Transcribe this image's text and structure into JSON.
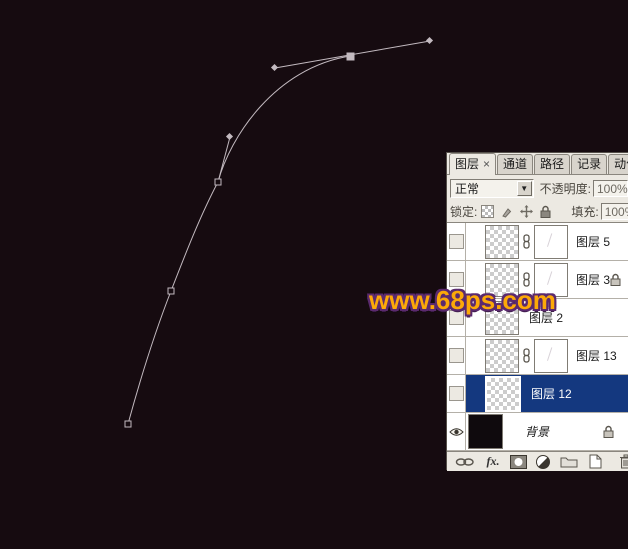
{
  "canvas": {
    "watermark": "www.68ps.com",
    "colors": {
      "background": "#160b10",
      "path": "#c3bac0",
      "watermark_fill": "#fca908",
      "watermark_outline": "#5b2a6e",
      "selected_row": "#14387f"
    },
    "pen_path": {
      "anchors": [
        [
          128,
          424
        ],
        [
          171,
          291
        ],
        [
          218,
          182
        ],
        [
          350,
          56
        ]
      ],
      "selected_anchor": [
        350,
        56
      ],
      "handle_points": [
        [
          230,
          137
        ],
        [
          275,
          68
        ],
        [
          430,
          41
        ]
      ]
    }
  },
  "panel": {
    "tabs": [
      {
        "label": "图层",
        "close_label": "×",
        "active": true
      },
      {
        "label": "通道",
        "active": false
      },
      {
        "label": "路径",
        "active": false
      },
      {
        "label": "记录",
        "active": false
      },
      {
        "label": "动作",
        "active": false
      }
    ],
    "blend_mode_value": "正常",
    "dropdown_arrow": "▼",
    "opacity_label": "不透明度:",
    "opacity_value": "100%",
    "lock_label": "锁定:",
    "fill_label": "填充:",
    "fill_value": "100%",
    "layers": [
      {
        "name": "图层 5",
        "visible": false,
        "mask": true,
        "locked": false,
        "selected": false
      },
      {
        "name": "图层 3",
        "visible": false,
        "mask": true,
        "locked": true,
        "selected": false
      },
      {
        "name": "图层 2",
        "visible": false,
        "mask": false,
        "locked": false,
        "selected": false
      },
      {
        "name": "图层 13",
        "visible": false,
        "mask": true,
        "locked": false,
        "selected": false
      },
      {
        "name": "图层 12",
        "visible": false,
        "mask": false,
        "locked": false,
        "selected": true
      },
      {
        "name": "背景",
        "visible": true,
        "mask": false,
        "locked": true,
        "selected": false
      }
    ],
    "bottom_bar": {
      "fx_label": "fx."
    }
  }
}
